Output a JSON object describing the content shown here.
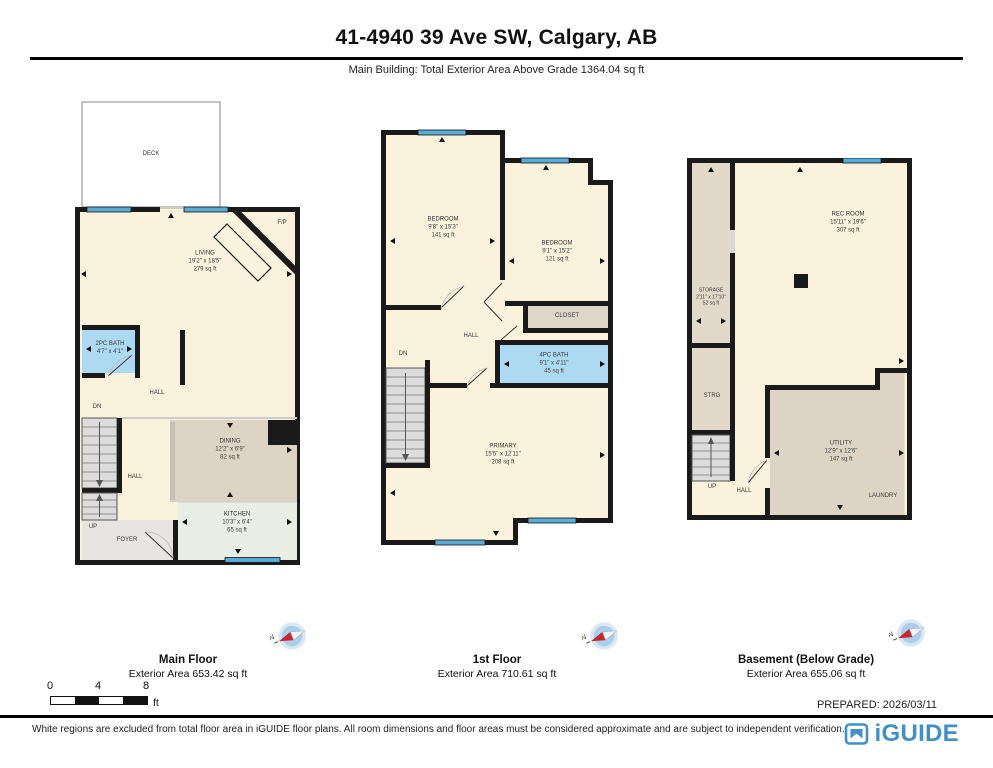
{
  "header": {
    "title": "41-4940 39 Ave SW, Calgary, AB",
    "subtitle": "Main Building: Total Exterior Area Above Grade 1364.04 sq ft"
  },
  "plans": {
    "main": {
      "name": "Main Floor",
      "area": "Exterior Area 653.42 sq ft",
      "rooms": {
        "deck": {
          "name": "DECK"
        },
        "living": {
          "name": "LIVING",
          "dims": "19'2\" x 18'5\"",
          "area": "279 sq ft"
        },
        "fireplace": {
          "name": "F/P"
        },
        "bath": {
          "name": "2PC BATH",
          "dims": "4'7\" x 4'1\""
        },
        "hall_upper": {
          "name": "HALL"
        },
        "hall_lower": {
          "name": "HALL"
        },
        "stairs_down": {
          "name": "DN"
        },
        "stairs_up": {
          "name": "UP"
        },
        "foyer": {
          "name": "FOYER"
        },
        "dining": {
          "name": "DINING",
          "dims": "12'2\" x 6'9\"",
          "area": "82 sq ft"
        },
        "kitchen": {
          "name": "KITCHEN",
          "dims": "10'3\" x 6'4\"",
          "area": "65 sq ft"
        }
      }
    },
    "first": {
      "name": "1st Floor",
      "area": "Exterior Area 710.61 sq ft",
      "rooms": {
        "bedroom_left": {
          "name": "BEDROOM",
          "dims": "9'8\" x 15'3\"",
          "area": "141 sq ft"
        },
        "bedroom_right": {
          "name": "BEDROOM",
          "dims": "9'1\" x 15'2\"",
          "area": "121 sq ft"
        },
        "closet": {
          "name": "CLOSET"
        },
        "bath": {
          "name": "4PC BATH",
          "dims": "9'1\" x 4'11\"",
          "area": "45 sq ft"
        },
        "hall": {
          "name": "HALL"
        },
        "stairs_down": {
          "name": "DN"
        },
        "primary": {
          "name": "PRIMARY",
          "dims": "15'5\" x 12'11\"",
          "area": "208 sq ft"
        }
      }
    },
    "basement": {
      "name": "Basement (Below Grade)",
      "area": "Exterior Area 655.06 sq ft",
      "rooms": {
        "rec": {
          "name": "REC ROOM",
          "dims": "15'11\" x 19'6\"",
          "area": "307 sq ft"
        },
        "storage": {
          "name": "STORAGE",
          "dims": "2'11\" x 17'10\"",
          "area": "52 sq ft"
        },
        "strg": {
          "name": "STRG"
        },
        "utility": {
          "name": "UTILITY",
          "dims": "12'9\" x 12'6\"",
          "area": "147 sq ft"
        },
        "laundry": {
          "name": "LAUNDRY"
        },
        "hall": {
          "name": "HALL"
        },
        "stairs_up": {
          "name": "UP"
        }
      }
    }
  },
  "compass": {
    "north": "N"
  },
  "scale_bar": {
    "t0": "0",
    "t4": "4",
    "t8": "8",
    "unit": "ft"
  },
  "prepared": "PREPARED: 2026/03/11",
  "footer": {
    "disclaimer": "White regions are excluded from total floor area in iGUIDE floor plans. All room dimensions and floor areas must be considered approximate and are subject to independent verification.",
    "brand": "iGUIDE"
  },
  "colors": {
    "wall": "#1a1a1a",
    "floor_cream": "#faf2dc",
    "floor_taupe": "#ddd4c6",
    "floor_kitchen": "#e9efe4",
    "floor_bath_blue": "#aed9f2",
    "window_blue": "#5aacd8",
    "brand_blue": "#4191c8"
  }
}
